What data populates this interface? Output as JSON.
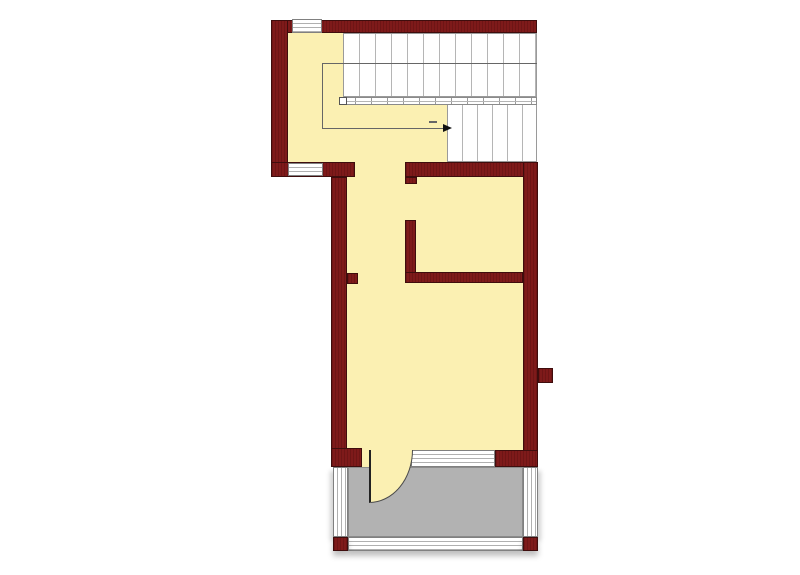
{
  "canvas": {
    "width": 800,
    "height": 575
  },
  "colors": {
    "wall": "#7E1A1A",
    "wall-edge": "#3F0D0D",
    "cream": "#FBF0B2",
    "terrace": "#B2B2B2",
    "terrace-edge": "#8C8C8C",
    "stair-edge": "#9A9A9A",
    "tread": "#B5B5B5",
    "win-edge": "#808080",
    "win-line": "#B0B0B0",
    "guide": "#666666"
  },
  "elements": [
    {
      "name": "floor-stair-hall",
      "type": "floor",
      "x": 288,
      "y": 33,
      "w": 159,
      "h": 129
    },
    {
      "name": "floor-main-room",
      "type": "floor",
      "x": 347,
      "y": 162,
      "w": 176,
      "h": 288
    },
    {
      "name": "floor-door-threshold",
      "type": "floor",
      "x": 362,
      "y": 450,
      "w": 50,
      "h": 17
    },
    {
      "name": "staircase-upper-flight",
      "type": "stairs",
      "variant": "treads-16",
      "x": 343,
      "y": 33,
      "w": 194,
      "h": 64
    },
    {
      "name": "staircase-lower-flight",
      "type": "stairs",
      "variant": "treads-15",
      "x": 447,
      "y": 104,
      "w": 90,
      "h": 58
    },
    {
      "name": "stair-handrail",
      "type": "rail",
      "x": 339,
      "y": 97,
      "w": 198,
      "h": 8
    },
    {
      "name": "stair-newel-post",
      "type": "newel",
      "x": 339,
      "y": 97,
      "w": 8,
      "h": 8
    },
    {
      "name": "stair-walk-line-top",
      "type": "line",
      "x": 322,
      "y": 63,
      "w": 215,
      "h": 1
    },
    {
      "name": "stair-walk-line-left",
      "type": "line",
      "x": 322,
      "y": 63,
      "w": 1,
      "h": 66
    },
    {
      "name": "stair-walk-line-bottom",
      "type": "line",
      "x": 322,
      "y": 128,
      "w": 122,
      "h": 1
    },
    {
      "name": "stair-walk-line-tick",
      "type": "line",
      "x": 429,
      "y": 121,
      "w": 8,
      "h": 2
    },
    {
      "name": "stair-direction-arrow",
      "type": "arrow-right",
      "x": 443,
      "y": 124,
      "w": 0,
      "h": 0
    },
    {
      "name": "wall-top",
      "type": "wall",
      "x": 271,
      "y": 20,
      "w": 266,
      "h": 13
    },
    {
      "name": "wall-left",
      "type": "wall",
      "x": 271,
      "y": 20,
      "w": 17,
      "h": 157
    },
    {
      "name": "wall-bumpout-bottom",
      "type": "wall",
      "x": 271,
      "y": 162,
      "w": 84,
      "h": 15
    },
    {
      "name": "wall-main-left",
      "type": "wall",
      "x": 331,
      "y": 177,
      "w": 16,
      "h": 290
    },
    {
      "name": "wall-pier-left-inner",
      "type": "wall",
      "x": 347,
      "y": 273,
      "w": 11,
      "h": 11
    },
    {
      "name": "wall-main-top-right",
      "type": "wall",
      "x": 405,
      "y": 162,
      "w": 132,
      "h": 15
    },
    {
      "name": "wall-pier-partition-top",
      "type": "wall",
      "x": 405,
      "y": 177,
      "w": 12,
      "h": 7
    },
    {
      "name": "wall-right",
      "type": "wall",
      "x": 523,
      "y": 162,
      "w": 15,
      "h": 305
    },
    {
      "name": "wall-pier-right-outer",
      "type": "wall",
      "x": 538,
      "y": 368,
      "w": 15,
      "h": 15
    },
    {
      "name": "wall-partition-vertical",
      "type": "wall",
      "x": 405,
      "y": 220,
      "w": 11,
      "h": 63
    },
    {
      "name": "wall-partition-horizontal",
      "type": "wall",
      "x": 405,
      "y": 272,
      "w": 118,
      "h": 11
    },
    {
      "name": "wall-bottom-left-corner",
      "type": "wall",
      "x": 331,
      "y": 448,
      "w": 31,
      "h": 19
    },
    {
      "name": "wall-bottom-right-corner",
      "type": "wall",
      "x": 495,
      "y": 450,
      "w": 43,
      "h": 17
    },
    {
      "name": "window-top",
      "type": "window-h",
      "x": 292,
      "y": 19,
      "w": 30,
      "h": 14
    },
    {
      "name": "window-bumpout-bottom",
      "type": "window-h",
      "x": 288,
      "y": 163,
      "w": 35,
      "h": 13
    },
    {
      "name": "window-main-bottom",
      "type": "window-h",
      "x": 411,
      "y": 450,
      "w": 84,
      "h": 17
    },
    {
      "name": "terrace-floor",
      "type": "terrace",
      "x": 348,
      "y": 467,
      "w": 175,
      "h": 70
    },
    {
      "name": "terrace-frame-left",
      "type": "window-v",
      "variant": "shadow-left",
      "x": 333,
      "y": 467,
      "w": 15,
      "h": 70
    },
    {
      "name": "terrace-frame-right",
      "type": "window-v",
      "variant": "shadow-right",
      "x": 523,
      "y": 467,
      "w": 15,
      "h": 70
    },
    {
      "name": "terrace-frame-bottom",
      "type": "window-h",
      "variant": "shadow-bottom",
      "x": 348,
      "y": 537,
      "w": 175,
      "h": 14
    },
    {
      "name": "terrace-corner-block-left",
      "type": "wall",
      "variant": "shadow-bottom",
      "x": 333,
      "y": 537,
      "w": 15,
      "h": 14
    },
    {
      "name": "terrace-corner-block-right",
      "type": "wall",
      "variant": "shadow-bottom",
      "x": 523,
      "y": 537,
      "w": 15,
      "h": 14
    },
    {
      "name": "door-swing",
      "type": "door-arc",
      "x": 369,
      "y": 450,
      "w": 44,
      "h": 53
    }
  ]
}
